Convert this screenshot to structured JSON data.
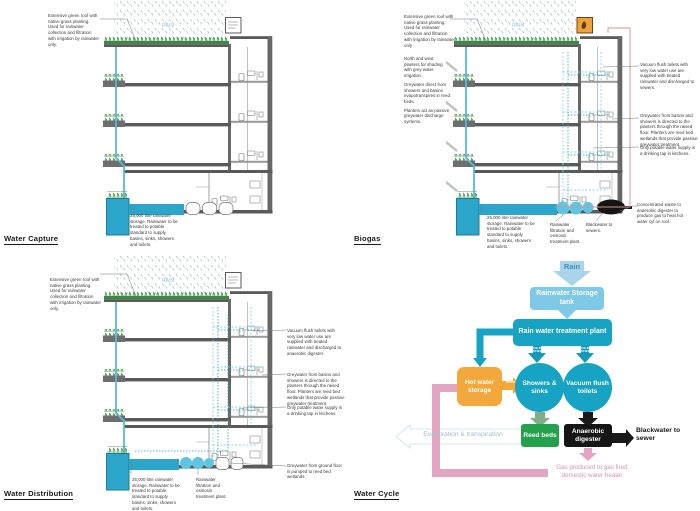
{
  "titles": {
    "water_capture": "Water Capture",
    "biogas": "Biogas",
    "water_distribution": "Water Distribution",
    "water_cycle": "Water Cycle"
  },
  "notes": {
    "rain": "RAIN",
    "green_roof": "Extensive green roof with native grass planting. Used for rainwater collection and filtration with irrigation by rainwater only.",
    "storage": "25,000 litre rainwater storage. Rainwater to be treated to potable standard to supply basins, sinks, showers and toilets.",
    "greywater": "Greywater from basins and showers is directed to the planters through the raised floor. Planters are reed bed wetlands that provide passive greywater treatment.",
    "potable": "Only potable water supply is a drinking tap in kitchens.",
    "filtration": "Rainwater filtration and osmosis treatment plant."
  },
  "biogas_notes": {
    "planters_shading": "North and west planters for shading with grey water irrigation.",
    "planters_evap": "Greywater direct from showers and basins evapotranspires in reed beds.",
    "planters_passive": "Planters act as passive greywater discharge systems.",
    "vacuum_toilets": "Vacuum flush toilets with very low water use are supplied with treated rainwater and discharged to sewers.",
    "concentrated_waste": "Concentrated waste to anaerobic digester to produce gas to heat hot water cyl on roof.",
    "blackwater": "Blackwater to sewers."
  },
  "distribution_notes": {
    "vacuum_toilets": "Vacuum flush toilets with very low water use are supplied with treated rainwater and discharged to anaerobic digester.",
    "ground_floor": "Greywater from ground floor is pumped to reed bed wetlands."
  },
  "water_cycle": {
    "rain": "Rain",
    "storage_tank": "Rainwater Storage tank",
    "treatment_plant": "Rain water treatment plant",
    "cold_water": "COLD WATER",
    "hot_water": "HOT WATER",
    "hot_storage": "Hot water storage",
    "showers": "Showers & sinks",
    "vacuum": "Vacuum flush toilets",
    "reed_beds": "Reed beds",
    "digester": "Anaerobic digester",
    "blackwater": "Blackwater to sewer",
    "evaporation": "Evaporation & transpiration",
    "gas": "Gas produced to gas fired domestic water heater"
  },
  "colors": {
    "teal": "#17a3c4",
    "light_blue": "#7fc9e6",
    "orange": "#f3a83e",
    "green": "#23a14b",
    "black": "#161616",
    "pink": "#e3a5c4",
    "tank_blue": "#2ba6ca"
  }
}
